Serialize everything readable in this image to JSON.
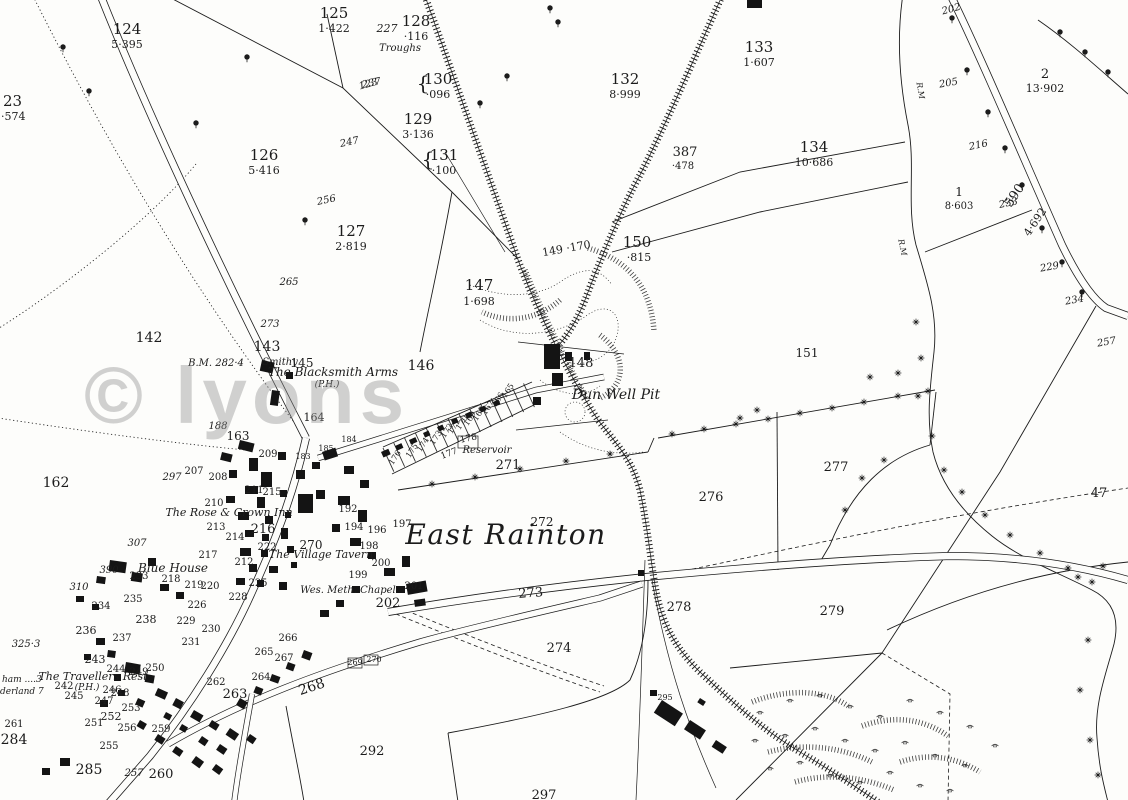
{
  "region_name": "East Rainton",
  "watermark_text": "© lyons",
  "colors": {
    "ink": "#1c1c1c",
    "paper": "#fdfdfb",
    "watermark": "#8f8f8f"
  },
  "labels": [
    {
      "t": "124",
      "x": 127,
      "y": 34,
      "s": 15,
      "k": "num"
    },
    {
      "t": "5·395",
      "x": 127,
      "y": 48,
      "s": 11,
      "k": "num"
    },
    {
      "t": "125",
      "x": 334,
      "y": 18,
      "s": 15,
      "k": "num"
    },
    {
      "t": "1·422",
      "x": 334,
      "y": 32,
      "s": 11,
      "k": "num"
    },
    {
      "t": "128",
      "x": 416,
      "y": 26,
      "s": 15,
      "k": "num"
    },
    {
      "t": "·116",
      "x": 416,
      "y": 40,
      "s": 11,
      "k": "num"
    },
    {
      "t": "23",
      "x": 3,
      "y": 106,
      "s": 15,
      "k": "num",
      "a": "s"
    },
    {
      "t": "·574",
      "x": 1,
      "y": 120,
      "s": 11,
      "k": "num",
      "a": "s"
    },
    {
      "t": "{",
      "x": 423,
      "y": 90,
      "s": 20,
      "k": "num"
    },
    {
      "t": "130",
      "x": 438,
      "y": 84,
      "s": 15,
      "k": "num"
    },
    {
      "t": "·096",
      "x": 438,
      "y": 98,
      "s": 11,
      "k": "num"
    },
    {
      "t": "129",
      "x": 418,
      "y": 124,
      "s": 15,
      "k": "num"
    },
    {
      "t": "3·136",
      "x": 418,
      "y": 138,
      "s": 11,
      "k": "num"
    },
    {
      "t": "{",
      "x": 428,
      "y": 166,
      "s": 20,
      "k": "num"
    },
    {
      "t": "131",
      "x": 444,
      "y": 160,
      "s": 15,
      "k": "num"
    },
    {
      "t": "·100",
      "x": 444,
      "y": 174,
      "s": 11,
      "k": "num"
    },
    {
      "t": "132",
      "x": 625,
      "y": 84,
      "s": 15,
      "k": "num"
    },
    {
      "t": "8·999",
      "x": 625,
      "y": 98,
      "s": 11,
      "k": "num"
    },
    {
      "t": "133",
      "x": 759,
      "y": 52,
      "s": 15,
      "k": "num"
    },
    {
      "t": "1·607",
      "x": 759,
      "y": 66,
      "s": 11,
      "k": "num"
    },
    {
      "t": "126",
      "x": 264,
      "y": 160,
      "s": 15,
      "k": "num"
    },
    {
      "t": "5·416",
      "x": 264,
      "y": 174,
      "s": 11,
      "k": "num"
    },
    {
      "t": "127",
      "x": 351,
      "y": 236,
      "s": 15,
      "k": "num"
    },
    {
      "t": "2·819",
      "x": 351,
      "y": 250,
      "s": 11,
      "k": "num"
    },
    {
      "t": "387",
      "x": 685,
      "y": 156,
      "s": 13,
      "k": "num"
    },
    {
      "t": "·478",
      "x": 683,
      "y": 169,
      "s": 10,
      "k": "num"
    },
    {
      "t": "134",
      "x": 814,
      "y": 152,
      "s": 15,
      "k": "num"
    },
    {
      "t": "10·686",
      "x": 814,
      "y": 166,
      "s": 11,
      "k": "num"
    },
    {
      "t": "2",
      "x": 1045,
      "y": 78,
      "s": 13,
      "k": "num"
    },
    {
      "t": "13·902",
      "x": 1045,
      "y": 92,
      "s": 11,
      "k": "num"
    },
    {
      "t": "1",
      "x": 959,
      "y": 196,
      "s": 12,
      "k": "num"
    },
    {
      "t": "8·603",
      "x": 959,
      "y": 209,
      "s": 10,
      "k": "num"
    },
    {
      "t": "147",
      "x": 479,
      "y": 290,
      "s": 15,
      "k": "num"
    },
    {
      "t": "1·698",
      "x": 479,
      "y": 305,
      "s": 11,
      "k": "num"
    },
    {
      "t": "150",
      "x": 637,
      "y": 247,
      "s": 15,
      "k": "num"
    },
    {
      "t": "·815",
      "x": 639,
      "y": 261,
      "s": 11,
      "k": "num"
    },
    {
      "t": "149 ·170",
      "x": 567,
      "y": 252,
      "s": 11,
      "k": "num",
      "r": -10
    },
    {
      "t": "142",
      "x": 149,
      "y": 342,
      "s": 14,
      "k": "num"
    },
    {
      "t": "143",
      "x": 267,
      "y": 351,
      "s": 14,
      "k": "num"
    },
    {
      "t": "145",
      "x": 302,
      "y": 367,
      "s": 12,
      "k": "num"
    },
    {
      "t": "146",
      "x": 421,
      "y": 370,
      "s": 14,
      "k": "num"
    },
    {
      "t": "148",
      "x": 581,
      "y": 367,
      "s": 13,
      "k": "num"
    },
    {
      "t": "151",
      "x": 807,
      "y": 357,
      "s": 12,
      "k": "num"
    },
    {
      "t": "162",
      "x": 56,
      "y": 487,
      "s": 14,
      "k": "num"
    },
    {
      "t": "163",
      "x": 238,
      "y": 440,
      "s": 12,
      "k": "num"
    },
    {
      "t": "164",
      "x": 314,
      "y": 421,
      "s": 11,
      "k": "num"
    },
    {
      "t": "183",
      "x": 303,
      "y": 459,
      "s": 8,
      "k": "num"
    },
    {
      "t": "185",
      "x": 326,
      "y": 451,
      "s": 8,
      "k": "num"
    },
    {
      "t": "184",
      "x": 349,
      "y": 442,
      "s": 8,
      "k": "num"
    },
    {
      "t": "271",
      "x": 508,
      "y": 469,
      "s": 13,
      "k": "num"
    },
    {
      "t": "272",
      "x": 542,
      "y": 526,
      "s": 12,
      "k": "num"
    },
    {
      "t": "273",
      "x": 531,
      "y": 597,
      "s": 13,
      "k": "num",
      "r": -4
    },
    {
      "t": "274",
      "x": 559,
      "y": 652,
      "s": 13,
      "k": "num"
    },
    {
      "t": "276",
      "x": 711,
      "y": 501,
      "s": 13,
      "k": "num"
    },
    {
      "t": "277",
      "x": 836,
      "y": 471,
      "s": 13,
      "k": "num"
    },
    {
      "t": "278",
      "x": 679,
      "y": 611,
      "s": 13,
      "k": "num"
    },
    {
      "t": "279",
      "x": 832,
      "y": 615,
      "s": 13,
      "k": "num"
    },
    {
      "t": "292",
      "x": 372,
      "y": 755,
      "s": 13,
      "k": "num"
    },
    {
      "t": "297",
      "x": 544,
      "y": 799,
      "s": 13,
      "k": "num"
    },
    {
      "t": "284",
      "x": 14,
      "y": 744,
      "s": 14,
      "k": "num"
    },
    {
      "t": "285",
      "x": 89,
      "y": 774,
      "s": 14,
      "k": "num"
    },
    {
      "t": "295",
      "x": 665,
      "y": 700,
      "s": 8,
      "k": "num"
    },
    {
      "t": "260",
      "x": 161,
      "y": 778,
      "s": 13,
      "k": "num"
    },
    {
      "t": "263",
      "x": 235,
      "y": 698,
      "s": 13,
      "k": "num"
    },
    {
      "t": "268",
      "x": 313,
      "y": 691,
      "s": 14,
      "k": "num",
      "r": -18
    },
    {
      "t": "269",
      "x": 355,
      "y": 665,
      "s": 8,
      "k": "num"
    },
    {
      "t": "270",
      "x": 374,
      "y": 662,
      "s": 8,
      "k": "num"
    },
    {
      "t": "47",
      "x": 1099,
      "y": 497,
      "s": 13,
      "k": "num"
    },
    {
      "t": "209",
      "x": 268,
      "y": 457,
      "s": 10,
      "k": "num"
    },
    {
      "t": "207",
      "x": 194,
      "y": 474,
      "s": 10,
      "k": "num"
    },
    {
      "t": "208",
      "x": 218,
      "y": 480,
      "s": 10,
      "k": "num"
    },
    {
      "t": "210",
      "x": 214,
      "y": 506,
      "s": 10,
      "k": "num"
    },
    {
      "t": "211",
      "x": 254,
      "y": 493,
      "s": 10,
      "k": "num"
    },
    {
      "t": "215",
      "x": 272,
      "y": 495,
      "s": 10,
      "k": "num"
    },
    {
      "t": "213",
      "x": 216,
      "y": 530,
      "s": 10,
      "k": "num"
    },
    {
      "t": "214",
      "x": 235,
      "y": 540,
      "s": 10,
      "k": "num"
    },
    {
      "t": "216",
      "x": 263,
      "y": 533,
      "s": 13,
      "k": "num"
    },
    {
      "t": "217",
      "x": 208,
      "y": 558,
      "s": 10,
      "k": "num"
    },
    {
      "t": "222",
      "x": 267,
      "y": 550,
      "s": 10,
      "k": "num"
    },
    {
      "t": "225",
      "x": 258,
      "y": 586,
      "s": 10,
      "k": "num"
    },
    {
      "t": "228",
      "x": 238,
      "y": 600,
      "s": 10,
      "k": "num"
    },
    {
      "t": "219",
      "x": 194,
      "y": 588,
      "s": 10,
      "k": "num"
    },
    {
      "t": "220",
      "x": 210,
      "y": 589,
      "s": 10,
      "k": "num"
    },
    {
      "t": "226",
      "x": 197,
      "y": 608,
      "s": 10,
      "k": "num"
    },
    {
      "t": "212",
      "x": 244,
      "y": 565,
      "s": 10,
      "k": "num"
    },
    {
      "t": "218",
      "x": 171,
      "y": 582,
      "s": 10,
      "k": "num"
    },
    {
      "t": "270",
      "x": 311,
      "y": 549,
      "s": 12,
      "k": "num"
    },
    {
      "t": "192",
      "x": 348,
      "y": 512,
      "s": 10,
      "k": "num"
    },
    {
      "t": "194",
      "x": 354,
      "y": 530,
      "s": 10,
      "k": "num"
    },
    {
      "t": "196",
      "x": 377,
      "y": 533,
      "s": 10,
      "k": "num"
    },
    {
      "t": "197",
      "x": 402,
      "y": 527,
      "s": 10,
      "k": "num"
    },
    {
      "t": "198",
      "x": 369,
      "y": 549,
      "s": 10,
      "k": "num"
    },
    {
      "t": "199",
      "x": 358,
      "y": 578,
      "s": 10,
      "k": "num"
    },
    {
      "t": "200",
      "x": 381,
      "y": 566,
      "s": 10,
      "k": "num"
    },
    {
      "t": "201",
      "x": 414,
      "y": 589,
      "s": 10,
      "k": "num"
    },
    {
      "t": "202",
      "x": 388,
      "y": 607,
      "s": 13,
      "k": "num"
    },
    {
      "t": "229",
      "x": 186,
      "y": 624,
      "s": 10,
      "k": "num"
    },
    {
      "t": "230",
      "x": 211,
      "y": 632,
      "s": 10,
      "k": "num"
    },
    {
      "t": "231",
      "x": 191,
      "y": 645,
      "s": 10,
      "k": "num"
    },
    {
      "t": "233",
      "x": 139,
      "y": 579,
      "s": 10,
      "k": "num"
    },
    {
      "t": "235",
      "x": 133,
      "y": 602,
      "s": 10,
      "k": "num"
    },
    {
      "t": "234",
      "x": 101,
      "y": 609,
      "s": 10,
      "k": "num"
    },
    {
      "t": "236",
      "x": 86,
      "y": 634,
      "s": 11,
      "k": "num"
    },
    {
      "t": "237",
      "x": 122,
      "y": 641,
      "s": 10,
      "k": "num"
    },
    {
      "t": "238",
      "x": 146,
      "y": 623,
      "s": 11,
      "k": "num"
    },
    {
      "t": "242",
      "x": 64,
      "y": 689,
      "s": 10,
      "k": "num"
    },
    {
      "t": "243",
      "x": 95,
      "y": 663,
      "s": 11,
      "k": "num"
    },
    {
      "t": "244",
      "x": 116,
      "y": 672,
      "s": 10,
      "k": "num"
    },
    {
      "t": "245",
      "x": 74,
      "y": 699,
      "s": 10,
      "k": "num"
    },
    {
      "t": "246",
      "x": 112,
      "y": 693,
      "s": 10,
      "k": "num"
    },
    {
      "t": "247",
      "x": 104,
      "y": 704,
      "s": 10,
      "k": "num"
    },
    {
      "t": "248",
      "x": 120,
      "y": 696,
      "s": 10,
      "k": "num"
    },
    {
      "t": "249",
      "x": 139,
      "y": 675,
      "s": 10,
      "k": "num"
    },
    {
      "t": "250",
      "x": 155,
      "y": 671,
      "s": 10,
      "k": "num"
    },
    {
      "t": "251",
      "x": 94,
      "y": 726,
      "s": 10,
      "k": "num"
    },
    {
      "t": "252",
      "x": 111,
      "y": 720,
      "s": 11,
      "k": "num"
    },
    {
      "t": "253",
      "x": 131,
      "y": 711,
      "s": 10,
      "k": "num"
    },
    {
      "t": "255",
      "x": 109,
      "y": 749,
      "s": 10,
      "k": "num"
    },
    {
      "t": "256",
      "x": 127,
      "y": 731,
      "s": 10,
      "k": "num"
    },
    {
      "t": "259",
      "x": 161,
      "y": 732,
      "s": 10,
      "k": "num"
    },
    {
      "t": "261",
      "x": 14,
      "y": 727,
      "s": 10,
      "k": "num"
    },
    {
      "t": "262",
      "x": 216,
      "y": 685,
      "s": 10,
      "k": "num"
    },
    {
      "t": "264",
      "x": 261,
      "y": 680,
      "s": 10,
      "k": "num"
    },
    {
      "t": "265",
      "x": 264,
      "y": 655,
      "s": 10,
      "k": "num"
    },
    {
      "t": "266",
      "x": 288,
      "y": 641,
      "s": 10,
      "k": "num"
    },
    {
      "t": "267",
      "x": 284,
      "y": 661,
      "s": 10,
      "k": "num"
    },
    {
      "t": "165",
      "x": 510,
      "y": 392,
      "s": 8,
      "k": "num",
      "r": -56
    },
    {
      "t": "166",
      "x": 500,
      "y": 401,
      "s": 8,
      "k": "num",
      "r": -56
    },
    {
      "t": "167",
      "x": 490,
      "y": 409,
      "s": 8,
      "k": "num",
      "r": -56
    },
    {
      "t": "168",
      "x": 481,
      "y": 415,
      "s": 8,
      "k": "num",
      "r": -56
    },
    {
      "t": "169",
      "x": 472,
      "y": 420,
      "s": 8,
      "k": "num",
      "r": -56
    },
    {
      "t": "170",
      "x": 464,
      "y": 424,
      "s": 8,
      "k": "num",
      "r": -56
    },
    {
      "t": "171",
      "x": 456,
      "y": 428,
      "s": 8,
      "k": "num",
      "r": -56
    },
    {
      "t": "172",
      "x": 449,
      "y": 432,
      "s": 8,
      "k": "num",
      "r": -56
    },
    {
      "t": "173",
      "x": 438,
      "y": 439,
      "s": 8,
      "k": "num",
      "r": -56
    },
    {
      "t": "174",
      "x": 425,
      "y": 446,
      "s": 8,
      "k": "num",
      "r": -56
    },
    {
      "t": "175",
      "x": 414,
      "y": 452,
      "s": 8,
      "k": "num",
      "r": -56
    },
    {
      "t": "176",
      "x": 397,
      "y": 459,
      "s": 8,
      "k": "num",
      "r": -56
    },
    {
      "t": "177",
      "x": 450,
      "y": 456,
      "s": 9,
      "k": "num",
      "r": -20
    },
    {
      "t": "178",
      "x": 469,
      "y": 441,
      "s": 9,
      "k": "num",
      "r": -12
    },
    {
      "t": "227",
      "x": 387,
      "y": 32,
      "s": 11,
      "k": "spot"
    },
    {
      "t": "237",
      "x": 372,
      "y": 86,
      "s": 10,
      "k": "spot",
      "r": -12
    },
    {
      "t": "247",
      "x": 350,
      "y": 145,
      "s": 10,
      "k": "spot",
      "r": -12
    },
    {
      "t": "256",
      "x": 327,
      "y": 203,
      "s": 10,
      "k": "spot",
      "r": -12
    },
    {
      "t": "265",
      "x": 289,
      "y": 285,
      "s": 10,
      "k": "spot"
    },
    {
      "t": "273",
      "x": 270,
      "y": 327,
      "s": 10,
      "k": "spot"
    },
    {
      "t": "188",
      "x": 218,
      "y": 429,
      "s": 10,
      "k": "spot"
    },
    {
      "t": "123",
      "x": 369,
      "y": 87,
      "s": 10,
      "k": "spot",
      "r": -15
    },
    {
      "t": "307",
      "x": 137,
      "y": 546,
      "s": 10,
      "k": "spot"
    },
    {
      "t": "390",
      "x": 109,
      "y": 573,
      "s": 10,
      "k": "spot"
    },
    {
      "t": "310",
      "x": 79,
      "y": 590,
      "s": 10,
      "k": "spot"
    },
    {
      "t": "325·3",
      "x": 26,
      "y": 647,
      "s": 10,
      "k": "spot"
    },
    {
      "t": "297",
      "x": 172,
      "y": 480,
      "s": 10,
      "k": "spot"
    },
    {
      "t": "257",
      "x": 134,
      "y": 776,
      "s": 10,
      "k": "spot"
    },
    {
      "t": "202",
      "x": 952,
      "y": 12,
      "s": 10,
      "k": "spot",
      "r": -15
    },
    {
      "t": "205",
      "x": 949,
      "y": 86,
      "s": 10,
      "k": "spot",
      "r": -10
    },
    {
      "t": "216",
      "x": 979,
      "y": 148,
      "s": 10,
      "k": "spot",
      "r": -12
    },
    {
      "t": "233",
      "x": 1009,
      "y": 206,
      "s": 10,
      "k": "spot",
      "r": -12
    },
    {
      "t": "229",
      "x": 1050,
      "y": 270,
      "s": 10,
      "k": "spot",
      "r": -10
    },
    {
      "t": "234",
      "x": 1075,
      "y": 303,
      "s": 10,
      "k": "spot",
      "r": -10
    },
    {
      "t": "257",
      "x": 1107,
      "y": 345,
      "s": 10,
      "k": "spot",
      "r": -10
    },
    {
      "t": "R.M",
      "x": 918,
      "y": 91,
      "s": 8,
      "k": "spot",
      "r": 80
    },
    {
      "t": "R.M",
      "x": 900,
      "y": 248,
      "s": 8,
      "k": "spot",
      "r": 78
    },
    {
      "t": "B.M. 282·4",
      "x": 216,
      "y": 366,
      "s": 10,
      "k": "name"
    },
    {
      "t": "590·",
      "x": 1019,
      "y": 196,
      "s": 13,
      "k": "num",
      "r": -56
    },
    {
      "t": "4·692",
      "x": 1038,
      "y": 224,
      "s": 11,
      "k": "num",
      "r": -56
    },
    {
      "t": "Troughs",
      "x": 400,
      "y": 51,
      "s": 10,
      "k": "name"
    },
    {
      "t": "Smithy",
      "x": 280,
      "y": 365,
      "s": 10,
      "k": "name"
    },
    {
      "t": "The Blacksmith Arms",
      "x": 333,
      "y": 376,
      "s": 12,
      "k": "name"
    },
    {
      "t": "(P.H.)",
      "x": 327,
      "y": 387,
      "s": 9,
      "k": "name"
    },
    {
      "t": "Dun Well Pit",
      "x": 616,
      "y": 399,
      "s": 14,
      "k": "name"
    },
    {
      "t": "Reservoir",
      "x": 487,
      "y": 453,
      "s": 10,
      "k": "name"
    },
    {
      "t": "The Rose & Crown Inn",
      "x": 229,
      "y": 516,
      "s": 11,
      "k": "name"
    },
    {
      "t": "The Village Tavern",
      "x": 321,
      "y": 558,
      "s": 11,
      "k": "name"
    },
    {
      "t": "Blue House",
      "x": 173,
      "y": 572,
      "s": 12,
      "k": "name"
    },
    {
      "t": "Wes. Meth. Chapel",
      "x": 348,
      "y": 593,
      "s": 10,
      "k": "name"
    },
    {
      "t": "The Travellers Rest",
      "x": 93,
      "y": 680,
      "s": 11,
      "k": "name"
    },
    {
      "t": "(P.H.)",
      "x": 87,
      "y": 690,
      "s": 9,
      "k": "name"
    },
    {
      "t": "ham ....3",
      "x": 2,
      "y": 682,
      "s": 9,
      "k": "name",
      "a": "s"
    },
    {
      "t": "derland 7",
      "x": 0,
      "y": 694,
      "s": 9,
      "k": "name",
      "a": "s"
    },
    {
      "t": "East Rainton",
      "x": 506,
      "y": 544,
      "s": 28,
      "k": "big"
    }
  ]
}
